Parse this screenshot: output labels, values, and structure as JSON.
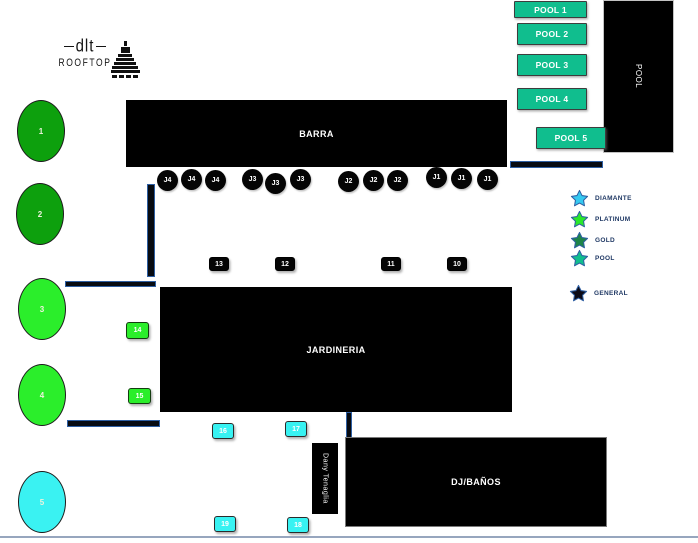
{
  "logo": {
    "brand": "dlt",
    "sub": "ROOFTOP"
  },
  "areas": {
    "barra": "BARRA",
    "jardineria": "JARDINERIA",
    "dj": "DJ/BAÑOS",
    "dany": "Dany Tenaglia",
    "pool": "POOL"
  },
  "pool_boxes": [
    {
      "label": "POOL 1"
    },
    {
      "label": "POOL 2"
    },
    {
      "label": "POOL 3"
    },
    {
      "label": "POOL 4"
    },
    {
      "label": "POOL 5"
    }
  ],
  "j_seats": [
    "J4",
    "J4",
    "J4",
    "J3",
    "J3",
    "J3",
    "J2",
    "J2",
    "J2",
    "J1",
    "J1",
    "J1"
  ],
  "black_tables": [
    "13",
    "12",
    "11",
    "10"
  ],
  "green_tables": [
    "14",
    "15"
  ],
  "cyan_tables": [
    "16",
    "17",
    "19",
    "18"
  ],
  "ovals": [
    {
      "label": "1",
      "color": "#0da00d"
    },
    {
      "label": "2",
      "color": "#0da00d"
    },
    {
      "label": "3",
      "color": "#2bee2b"
    },
    {
      "label": "4",
      "color": "#2bee2b"
    },
    {
      "label": "5",
      "color": "#3af2f2"
    }
  ],
  "legend": [
    {
      "label": "DIAMANTE",
      "color": "#35c9f0"
    },
    {
      "label": "PLATINUM",
      "color": "#2be82b"
    },
    {
      "label": "GOLD",
      "color": "#1e8449"
    },
    {
      "label": "POOL",
      "color": "#10be8e"
    },
    {
      "label": "GENERAL",
      "color": "#0b0b18"
    }
  ],
  "colors": {
    "teal": "#10be8e",
    "dark_green": "#0da00d",
    "bright_green": "#2bee2b",
    "cyan": "#38f2f2",
    "navy_wall_border": "#2e5fa3",
    "legend_text": "#1f3864"
  }
}
